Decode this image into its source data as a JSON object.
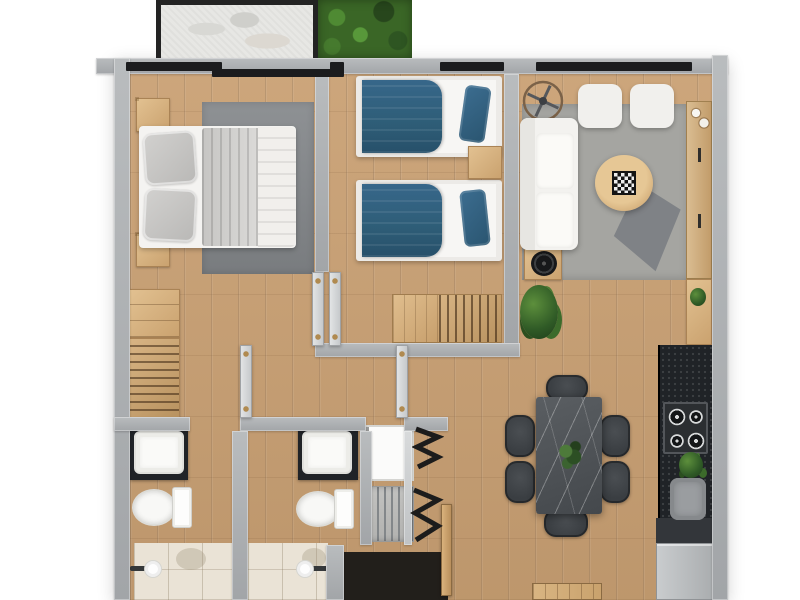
{
  "image_type": "3d-rendered apartment floor plan, top-down view, no visible text",
  "palette": {
    "wall": "#a2a5a8",
    "wall-light": "#c6c9cb",
    "wood": "#c9a073",
    "wood-dark": "#8a6239",
    "wood-light": "#dcba8c",
    "window-frame": "#1b1c1e",
    "teal": "#2e5d77",
    "rug": "#86898c",
    "rug-living": "#a2a29e",
    "white-fabric": "#f4f3f0",
    "counter-dark": "#202327",
    "stone-table": "#53575b",
    "chair": "#3a3e42",
    "grass": "#3a6626",
    "tile": "#eae3d6",
    "balcony-stone": "#e7e7e4",
    "appliance": "#bcbfc1",
    "brass": "#b08a50",
    "plant": "#356b2f",
    "entry-dark": "#221f1b"
  },
  "floor_plan": {
    "rooms": [
      {
        "name": "Balcony",
        "furniture": [
          "stone floor",
          "black railing frame",
          "sliding door"
        ]
      },
      {
        "name": "Garden patch",
        "furniture": [
          "grass"
        ]
      },
      {
        "name": "Master bedroom",
        "furniture": [
          "double bed with gray and white bedding",
          "gray area rug",
          "nightstand with lamp (x2)",
          "dresser",
          "open wardrobe with hanging clothes"
        ]
      },
      {
        "name": "Second bedroom",
        "furniture": [
          "twin bed with teal duvet (x2)",
          "nightstand",
          "open wardrobe with hanging clothes",
          "potted plant",
          "window"
        ]
      },
      {
        "name": "Living room",
        "furniture": [
          "white sofa",
          "white armchair (x2)",
          "round wooden coffee table with chessboard",
          "geometric gray rug",
          "side table with turntable",
          "ceiling fan",
          "wooden sideboard",
          "window"
        ]
      },
      {
        "name": "Dining area",
        "furniture": [
          "dark stone dining table",
          "dark dining chair (x6)",
          "plant centerpiece",
          "wooden doormat"
        ]
      },
      {
        "name": "Kitchen",
        "furniture": [
          "black granite counter",
          "4-burner gas hob",
          "sink",
          "refrigerator",
          "tall wooden cabinet",
          "small plant"
        ]
      },
      {
        "name": "Bathroom 1",
        "furniture": [
          "dark vanity with white sink",
          "toilet",
          "tiled walk-in shower",
          "towel roll holder"
        ]
      },
      {
        "name": "Bathroom 2",
        "furniture": [
          "dark vanity with white sink",
          "toilet",
          "tiled walk-in shower",
          "towel roll holder"
        ]
      },
      {
        "name": "Laundry closet",
        "furniture": [
          "washing machine",
          "drying rack",
          "bi-fold doors"
        ]
      },
      {
        "name": "Hallway and entry",
        "furniture": [
          "interior doors",
          "open entry door"
        ]
      }
    ]
  }
}
